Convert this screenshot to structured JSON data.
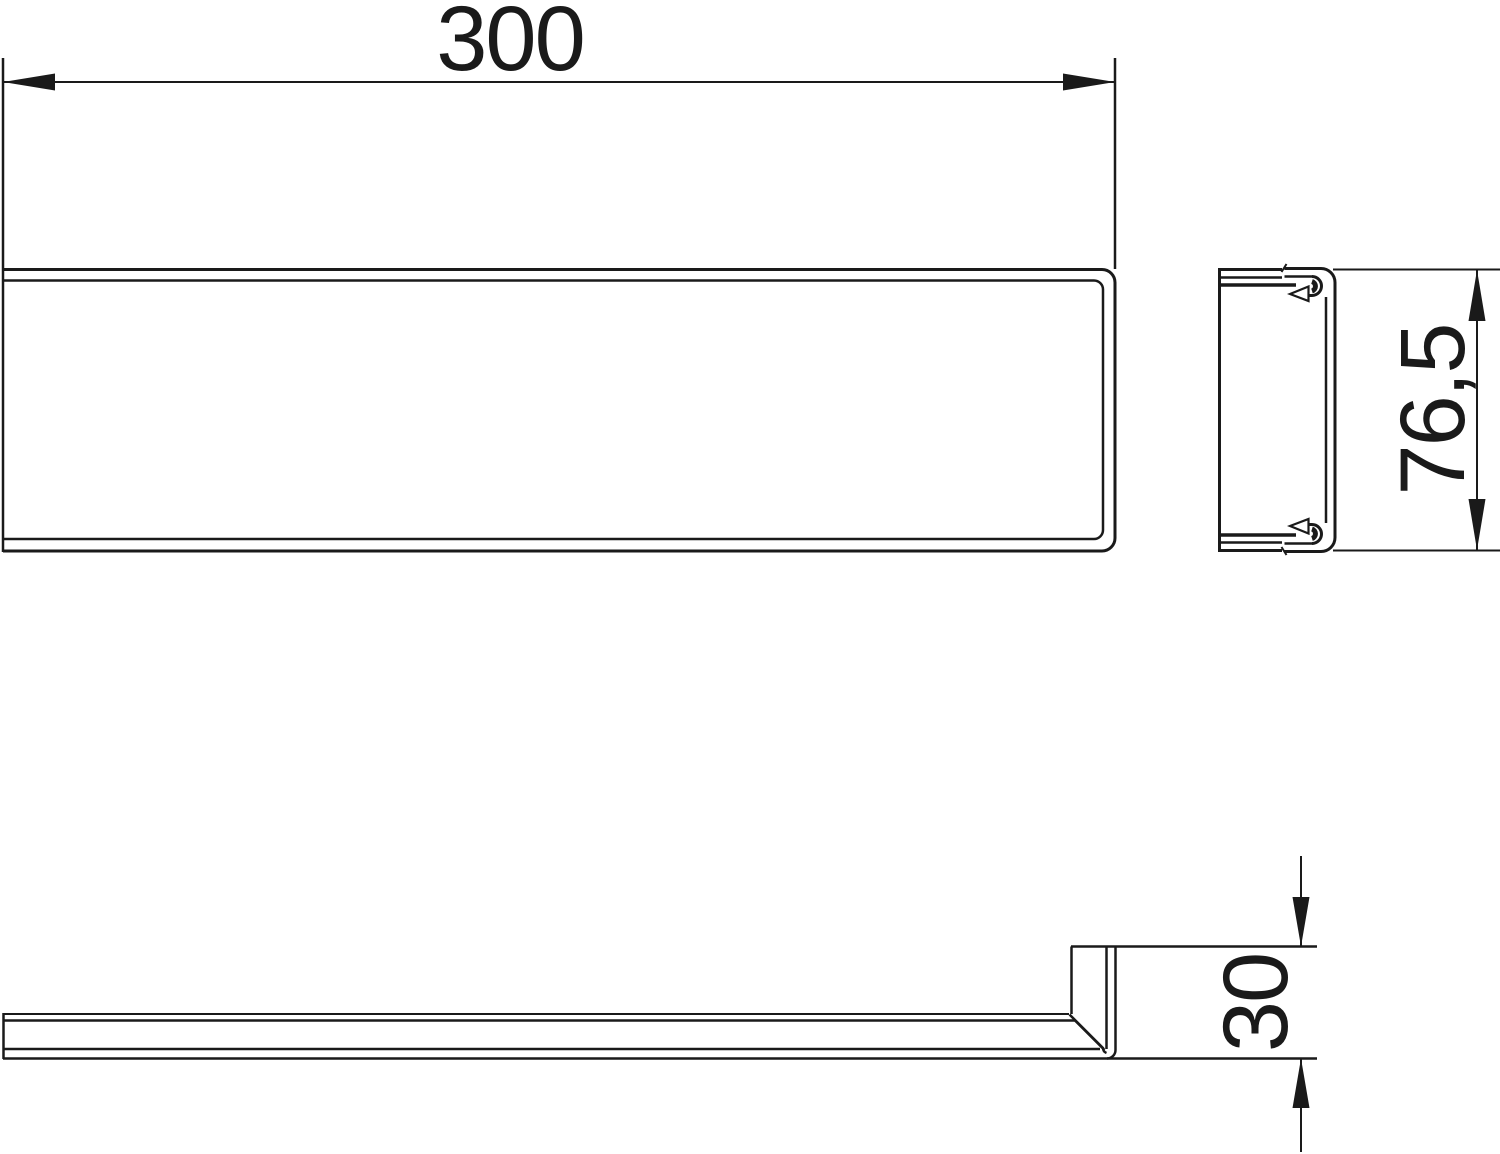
{
  "drawing": {
    "background": "#ffffff",
    "line_color": "#1a1a1a",
    "dimensions": {
      "length": {
        "value": "300"
      },
      "height": {
        "value": "76,5"
      },
      "depth": {
        "value": "30"
      }
    }
  }
}
